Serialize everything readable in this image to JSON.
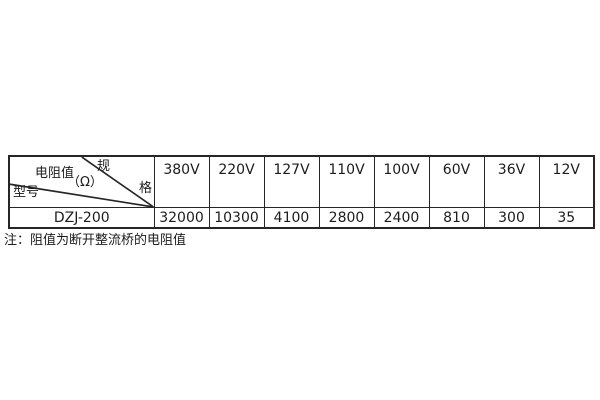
{
  "table": {
    "corner": {
      "spec_char_top": "规",
      "spec_char_bottom": "格",
      "resistance_label": "电阻值",
      "unit_label": "（Ω）",
      "model_label": "型号"
    },
    "columns": [
      "380V",
      "220V",
      "127V",
      "110V",
      "100V",
      "60V",
      "36V",
      "12V"
    ],
    "rows": [
      {
        "model": "DZJ-200",
        "values": [
          "32000",
          "10300",
          "4100",
          "2800",
          "2400",
          "810",
          "300",
          "35"
        ]
      }
    ]
  },
  "note": "注：阻值为断开整流桥的电阻值",
  "colors": {
    "border": "#262626",
    "text": "#1c1c1c",
    "background": "#ffffff"
  }
}
